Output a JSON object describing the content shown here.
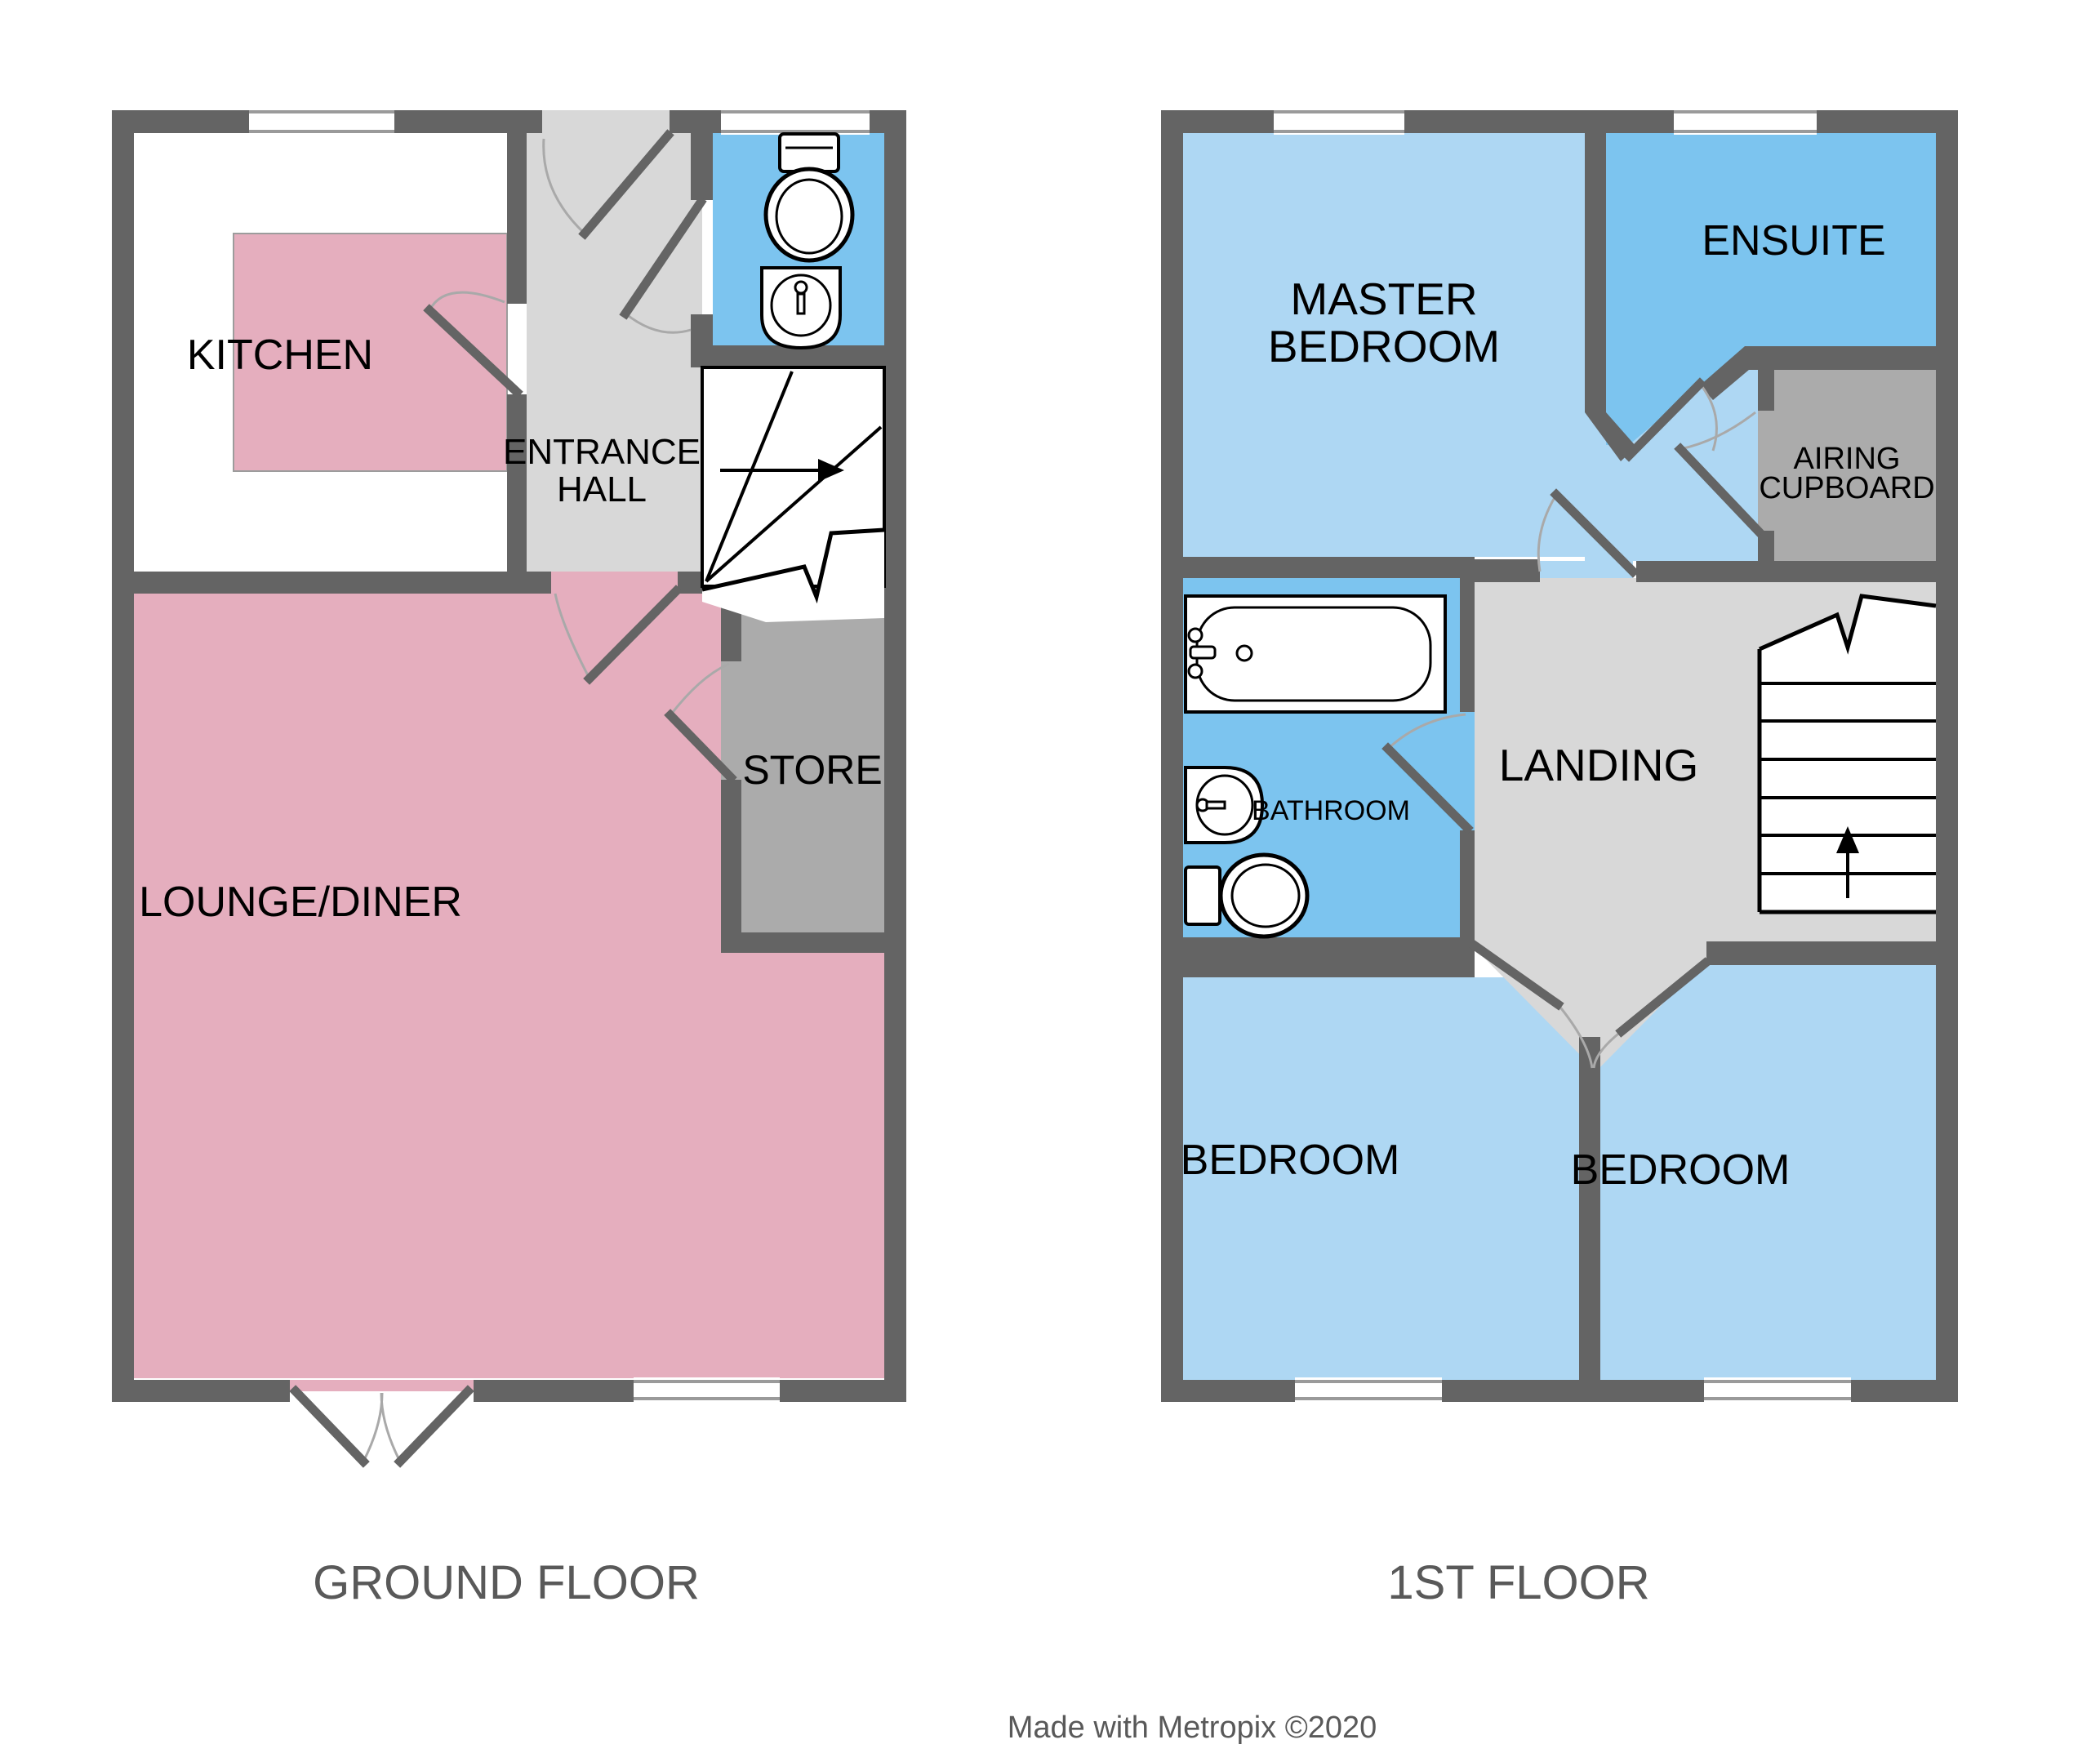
{
  "palette": {
    "wall": "#646464",
    "floor_light": "#D8D8D8",
    "floor_dark": "#ABABAB",
    "pink": "#E5AEBE",
    "light_blue": "#AED7F3",
    "mid_blue": "#7CC4EF",
    "window_line": "#9A9A9A",
    "door_arc": "#A9A9A9",
    "label_text": "#000000",
    "title_text": "#595959"
  },
  "ground_floor": {
    "title": "GROUND FLOOR",
    "rooms": {
      "kitchen": "KITCHEN",
      "entrance_hall": [
        "ENTRANCE",
        "HALL"
      ],
      "lounge": "LOUNGE/DINER",
      "store": "STORE"
    }
  },
  "first_floor": {
    "title": "1ST FLOOR",
    "rooms": {
      "master_bedroom": [
        "MASTER",
        "BEDROOM"
      ],
      "ensuite": "ENSUITE",
      "airing_cupboard": [
        "AIRING",
        "CUPBOARD"
      ],
      "bathroom": "BATHROOM",
      "landing": "LANDING",
      "bedroom_left": "BEDROOM",
      "bedroom_right": "BEDROOM"
    }
  },
  "credit": "Made with Metropix ©2020"
}
